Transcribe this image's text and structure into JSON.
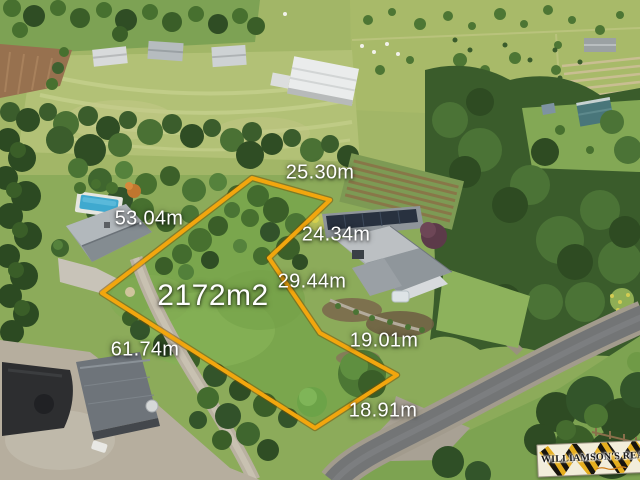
{
  "annotation": {
    "boundary_color": "#F2A60E",
    "area_label": "2172m2",
    "measurements": [
      {
        "position": "top-edge",
        "label": "25.30m"
      },
      {
        "position": "northwest-edge",
        "label": "53.04m"
      },
      {
        "position": "northeast-edge",
        "label": "24.34m"
      },
      {
        "position": "east-edge",
        "label": "29.44m"
      },
      {
        "position": "southeast-edge",
        "label": "19.01m"
      },
      {
        "position": "southwest-edge",
        "label": "61.74m"
      },
      {
        "position": "south-edge",
        "label": "18.91m"
      }
    ]
  },
  "watermark": {
    "brand_text": "WILLIAMSON'S REAL ES",
    "stripe_black": "#17140e",
    "stripe_yellow": "#e5ae1e",
    "background": "#f2edda"
  }
}
